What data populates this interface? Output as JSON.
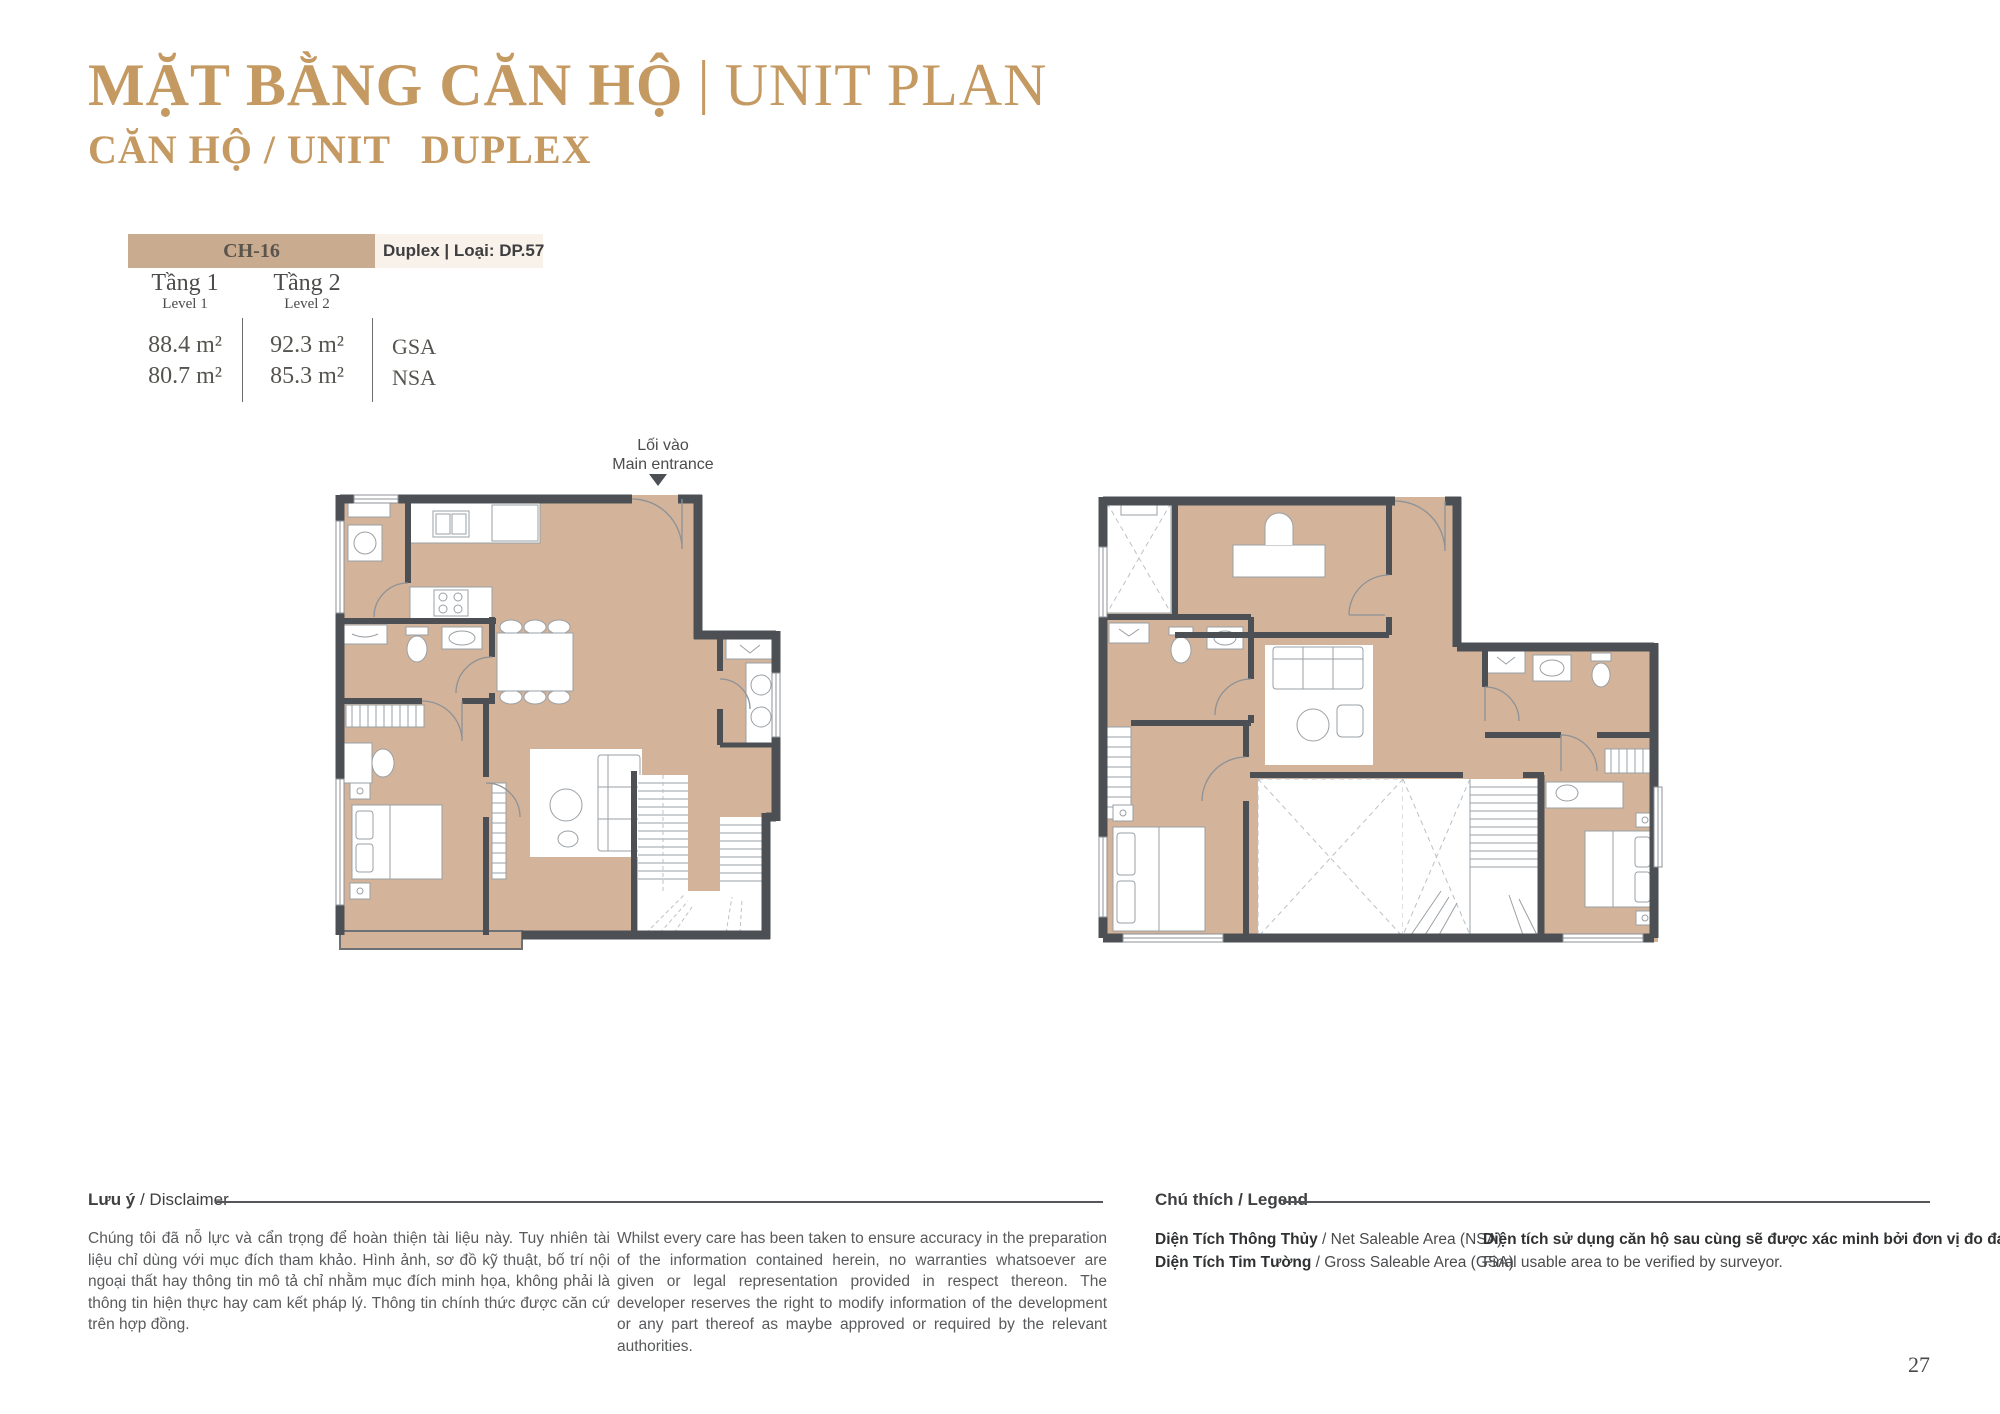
{
  "header": {
    "title_vi": "MẶT BẰNG CĂN HỘ",
    "title_sep": "|",
    "title_en": "UNIT PLAN",
    "subtitle_label": "CĂN HỘ / UNIT",
    "subtitle_value": "DUPLEX"
  },
  "unit_info": {
    "unit_code": "CH-16",
    "unit_type_label": "Duplex | Loại: DP.57",
    "levels": [
      {
        "name_vi": "Tầng 1",
        "name_en": "Level 1",
        "gsa": "88.4 m²",
        "nsa": "80.7 m²"
      },
      {
        "name_vi": "Tầng 2",
        "name_en": "Level 2",
        "gsa": "92.3 m²",
        "nsa": "85.3 m²"
      }
    ],
    "gsa_label": "GSA",
    "nsa_label": "NSA"
  },
  "entrance": {
    "label_vi": "Lối vào",
    "label_en": "Main entrance"
  },
  "disclaimer": {
    "heading_vi": "Lưu ý",
    "heading_rest": " / Disclaimer",
    "text_vi": "Chúng tôi đã nỗ lực và cẩn trọng để hoàn thiện tài liệu này. Tuy nhiên tài liệu chỉ dùng với mục đích tham khảo. Hình ảnh, sơ đồ kỹ thuật, bố trí nội ngoại thất hay thông tin mô tả chỉ nhằm mục đích minh họa, không phải là thông tin hiện thực hay cam kết pháp lý. Thông tin chính thức được căn cứ trên hợp đồng.",
    "text_en": "Whilst every care has been taken to ensure accuracy in the preparation of the information contained herein, no warranties whatsoever are given or legal representation provided in respect thereon. The developer reserves the right to modify information of the development or any part thereof as maybe approved or required by the relevant authorities."
  },
  "legend": {
    "heading": "Chú thích / Legend",
    "items": [
      {
        "vi": "Diện Tích Thông Thủy",
        "en": " / Net Saleable Area (NSA)"
      },
      {
        "vi": "Diện Tích Tim Tường",
        "en": " / Gross Saleable Area (GSA)"
      }
    ],
    "note_vi": "Diện tích sử dụng căn hộ sau cùng sẽ được xác minh bởi đơn vị đo đạc.",
    "note_en": "Final usable area to be verified by surveyor."
  },
  "footer": {
    "page_number": "27"
  },
  "colors": {
    "accent_gold": "#c49a62",
    "unit_bar_tan": "#c9ac90",
    "unit_bar_cream": "#f8f2ea",
    "plan_wall": "#4c5055",
    "plan_floor": "#d3b399",
    "text_dark": "#3f4042",
    "text_gray": "#58595b"
  }
}
